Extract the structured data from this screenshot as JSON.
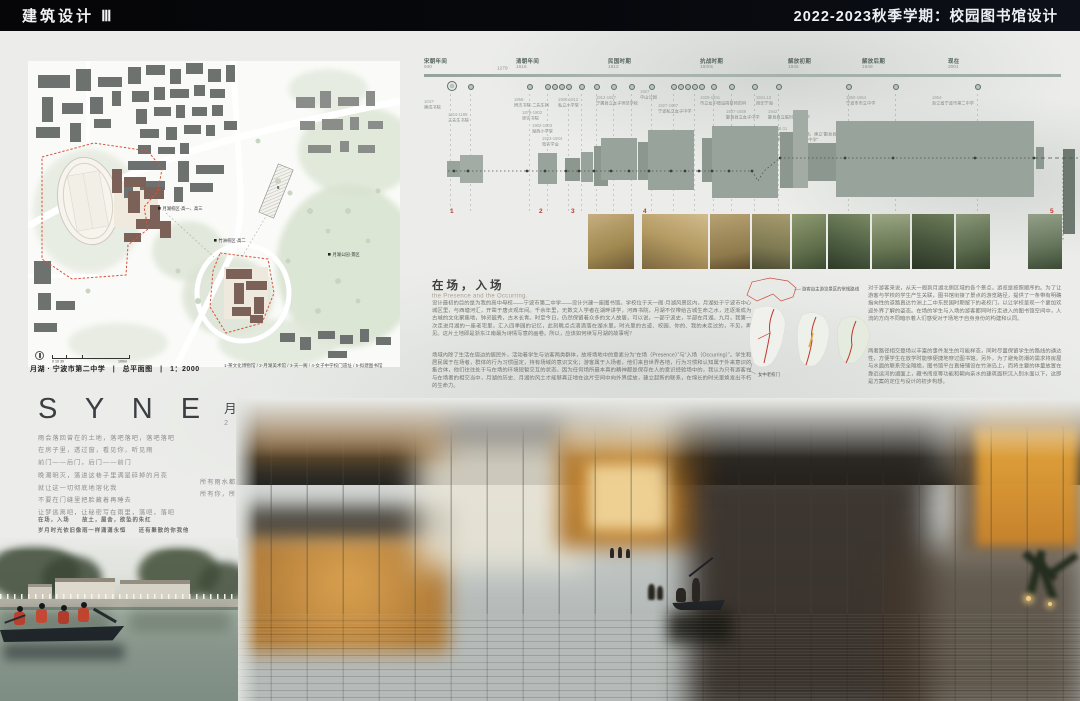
{
  "header": {
    "left_title": "建筑设计 Ⅲ",
    "right_title": "2022-2023秋季学期：校园图书馆设计"
  },
  "site_map": {
    "labels": {
      "campus_yuehu": "月湖校区·高一、高三",
      "campus_zhuzhou": "竹洲校区·高二",
      "park": "月湖公园·景区",
      "proposed_no": "5"
    },
    "scale": {
      "left": "0  10    30",
      "right": "100m"
    },
    "caption": "月湖 · 宁波市第二中学　|　总平面图　|　1：2000",
    "legend": "1-茶文化博物馆 / 2-月湖美术馆 / 3-天一阁 / 4-女子中学校门遗址 / 5-拟建图书馆"
  },
  "timeline": {
    "periods": [
      {
        "name": "宋朝年间",
        "year": "940"
      },
      {
        "name": "清朝年间",
        "year": "1616"
      },
      {
        "name": "民国时期",
        "year": "1912"
      },
      {
        "name": "抗战时期",
        "year": "1930s"
      },
      {
        "name": "解放初期",
        "year": "1945"
      },
      {
        "name": "解放后期",
        "year": "1949"
      },
      {
        "name": "现在",
        "year": "2001"
      }
    ],
    "first_period_end": "1279",
    "events": [
      {
        "year": "1047-",
        "name": "建成书院"
      },
      {
        "year": "1164-1189",
        "name": "三先生书院"
      },
      {
        "year": "1856-",
        "name": "辨志书院·二先生祠"
      },
      {
        "year": "1879-1902",
        "name": "崇实书院"
      },
      {
        "year": "1902-1903",
        "name": "湖西小学堂"
      },
      {
        "year": "1923-1934",
        "name": "效实学会"
      },
      {
        "year": "1906-1912",
        "name": "私立小学堂"
      },
      {
        "year": "1912-1927",
        "name": "宁属县立女子师范学校"
      },
      {
        "year": "1927",
        "name": "中山公园"
      },
      {
        "year": "1927-1937",
        "name": "宁波私立女子中学"
      },
      {
        "year": "1929-1931",
        "name": "市立女中增设简易师范科"
      },
      {
        "year": "1937-1939",
        "name": "鄞县县立女子中学"
      },
      {
        "year": "1941.10",
        "name": "西迁宁海"
      },
      {
        "year": "1942",
        "name": "鄞县县立临时联合中学"
      },
      {
        "year": "1946.01",
        "name": "抗战胜利后学校整顿，建立“鄞县县立中学”和“鄞县县立女子中学”"
      },
      {
        "year": "1950-1954",
        "name": "宁波市市立中学"
      },
      {
        "year": "1954-",
        "name": "浙江省宁波市第二中学"
      }
    ],
    "markers": [
      "1",
      "2",
      "3",
      "4",
      "5"
    ]
  },
  "essay": {
    "title": "在场，入场",
    "subtitle": "the Presence and the Occurring.",
    "p1": "设计最初的目的是为我的高中母校——宁波市第二中学——设计兴建一座图书馆。学校位于天一阁·月湖风景区内，月湖处于宁波市中心城区里，与西塘河汇，开凿于唐贞观年间。千余年里，无数文人学者在湖畔讲学，河西书院，月湖不仅带给古城生命之水，还逐渐成为古城的文化聚集地，钟灵毓秀，古木长青。时至今日，仍然保留着众多的文人故居，可以说，一部宁波史，半部在月湖。九月，我第一次走进月湖的一座老宅里，汇入四季园的记忆，此刻眺点点滴滴落在湖水里。时光里的古迹、校园、你的、我的未走过的，不见，再见。这片土地即是浙东江南最为诗情写意的画卷。所以，应该如何续写月湖的故事呢？",
    "p2": "场域内除了生活在周边的居民外，活动着学生与访客两类群体，故将场地中的意素分为“在场（Presence）”与“入场（Occurring）”。学生和居民属于在场者，群体的行为习惯固定，持有场域的意识文化；游客属于入场者，他们来自世界各地，行为习惯和认知属于外来意识的集合体，他们往往处于与在场的环境短暂交互的状态。因为任何场所最本真的精神都是保存在人的意识经验场中的，我认为只有游客在与在场者的相交当中，月湖的历史、月湖的风土才能够真正地在这片空间中向外界绽放，建立起新的联系，在绵长的时光里焕发出不朽的生命力。"
  },
  "diagrams": {
    "route_label": "游客自主游览景区的常规路线",
    "gate_label": "女中老校门"
  },
  "essay_right": {
    "p1": "对于游客来说，从天一阁到月湖北侧区域的各个景点，游览是按照顺序的。为了让游客与学校的学生产生关联，图书馆衔接了景点的游览路径，提供了一条带有明确指向性的道路直达竹洲上二中东民国时期留下的老校门，以让学校呈现一个更加欢迎外界了解的姿态。在场的学生与入场的游客都同时行走进入的图书馆空间中，人流的方向不同暗示着人们感受对于场地于自身身份的构建和认同。",
    "p2": "两者路径相交登场以丰富的事件发生的可能样态，同时尽量保留学生的路线的通达性，方便学生在放学时能够便捷地穿过图书馆。另外，为了避免防潮的需求将房屋与水面的联系完全隔绝，图书馆平台直接铺设在竹洲岛上，而将主要的体量放置在靠近运河的湖面上，藏书阅览等功能和朝向亲水的建筑面积沉入别水面以下，这即是方案的定位与设计的初步构想。"
  },
  "project": {
    "name": "S Y N E",
    "cn": "月 湖 图 书 馆",
    "date": "2 0 2 3 / 0 1 / 0 9"
  },
  "poem": {
    "left": [
      "雨会落回曾在的土地，落吧落吧，落吧落吧",
      "在房子里，透过窗，看见你，听见雨",
      "前门——后门，后门——前门",
      "晚潮明灭，落进这巷子里满是碎掉的月亮",
      "就让这一切彻底地溶化我",
      "不要在门缝里把脸藏着再睡去",
      "让梦逃离吧，让秘密写在雨里，落吧，落吧"
    ],
    "right": [
      "所有雨水都冲向时光的残影",
      "所有你，所有我，所有他，落吧，落吧"
    ],
    "footer": [
      "在场，入场　　故土，屋舍，欲坠的朱红",
      "岁月时光依旧像雨一样潇潇永恒　　还有聚散的你我他"
    ]
  },
  "colors": {
    "accent_red": "#c0392b",
    "board_black": "#070709",
    "glow_orange": "#d08a2e"
  }
}
